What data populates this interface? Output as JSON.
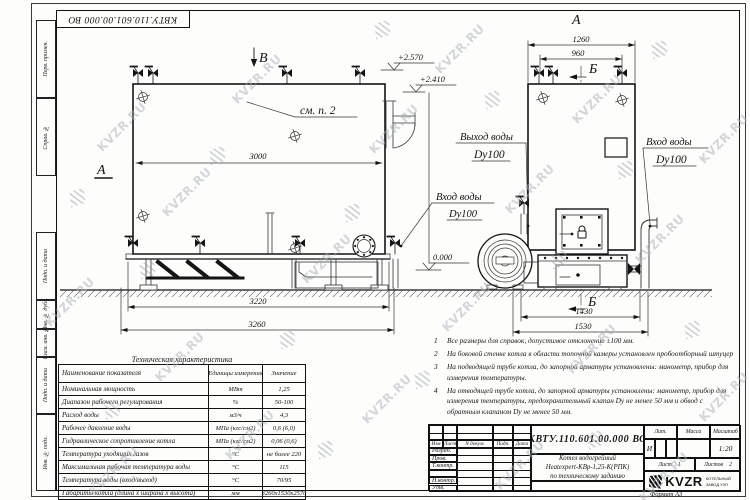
{
  "sheet": {
    "stamp_doc_number": "КВТУ.110.601.00.000  ВО",
    "format_label": "Формат  А3",
    "watermark_text": "KVZR.RU"
  },
  "frame": {
    "left_labels": [
      "Перв. примен.",
      "Справ. №",
      "Подп. и дата",
      "Инв. № дубл.",
      "Взам. инв. №",
      "Подп. и дата",
      "Инв. № подл."
    ]
  },
  "drawing": {
    "side_view": {
      "section_label": "А",
      "view_arrow_label": "В",
      "see_note_ref": "см. п. 2",
      "dim_inner_width": "3000",
      "dim_frame_width": "3220",
      "dim_overall_width": "3260",
      "elevation_top": "+2.570",
      "elevation_mid": "+2.410",
      "elevation_ground": "0.000",
      "inlet_label_line1": "Вход воды",
      "inlet_label_line2": "Dy100"
    },
    "front_view": {
      "view_label": "А",
      "section_label_top": "Б",
      "section_label_bottom": "Б",
      "dim_top_outer": "1260",
      "dim_top_inner": "960",
      "dim_base_inner": "1430",
      "dim_base_outer": "1530",
      "outlet_label_line1": "Выход воды",
      "outlet_label_line2": "Dy100",
      "inlet_label_line1": "Вход воды",
      "inlet_label_line2": "Dy100"
    }
  },
  "notes": [
    {
      "num": "1",
      "text": "Все размеры для справок, допустимое отклонение  ±100 мм."
    },
    {
      "num": "2",
      "text": "На боковой стенке котла в области топочной камеры установлен пробоотборный штуцер"
    },
    {
      "num": "3",
      "text": "На  подводящей трубе котла, до запорной арматуры установлены:  манометр, прибор для измерения температуры."
    },
    {
      "num": "4",
      "text": "На отводящей трубе котла, до запорной арматуры установлены:  манометр, прибор для измерения температуры, предохранительный клапан  Dу не менее  50 мм и обвод с обратным клапаном  Dу не менее  50 мм."
    }
  ],
  "tech_table": {
    "title": "Техническая характеристика",
    "header_name": "Наименование показателя",
    "header_units": "Единицы измерения",
    "header_value": "Значение",
    "rows": [
      {
        "name": "Номинальная мощность",
        "units": "МВт",
        "value": "1,25"
      },
      {
        "name": "Диапазон рабочего регулирования",
        "units": "%",
        "value": "50-100"
      },
      {
        "name": "Расход воды",
        "units": "м3/ч",
        "value": "4,3"
      },
      {
        "name": "Рабочее давление воды",
        "units": "МПа (кгс/см2)",
        "value": "0,6 (6,0)"
      },
      {
        "name": "Гидравлическое сопротивление котла",
        "units": "МПа (кгс/см2)",
        "value": "0,06 (0,6)"
      },
      {
        "name": "Температура уходящих газов",
        "units": "°С",
        "value": "не более 220"
      },
      {
        "name": "Максимальная рабочая температура воды",
        "units": "°С",
        "value": "115"
      },
      {
        "name": "Температура воды (вход/выход)",
        "units": "°С",
        "value": "70/95"
      },
      {
        "name": "Габариты котла (длина х ширина х высота)",
        "units": "мм",
        "value": "3260х1530х2570"
      }
    ]
  },
  "title_block": {
    "doc_number": "КВТУ.110.601.00.000  ВО",
    "product_lines": [
      "Котел водогрейный",
      "Heatexpert-КВр-1,25-К(РПК)",
      "по техническому заданию"
    ],
    "col_headers": {
      "izm": "Изм",
      "list": "Лист",
      "doc": "N докум.",
      "sign": "Подп.",
      "date": "Дата"
    },
    "row_labels": [
      "Разраб.",
      "Пров.",
      "Т.контр.",
      "",
      "Н.контр.",
      "Утв."
    ],
    "lit_header": "Лит.",
    "mass_header": "Масса",
    "scale_header": "Масштаб",
    "lit_value": "И",
    "scale_value": "1:20",
    "sheet_label": "Лист",
    "sheet_value": "1",
    "sheets_label": "Листов",
    "sheets_value": "2",
    "brand": "KVZR",
    "brand_sub_line1": "КОТЕЛЬНЫЙ",
    "brand_sub_line2": "ЗАВОД УЗП"
  }
}
